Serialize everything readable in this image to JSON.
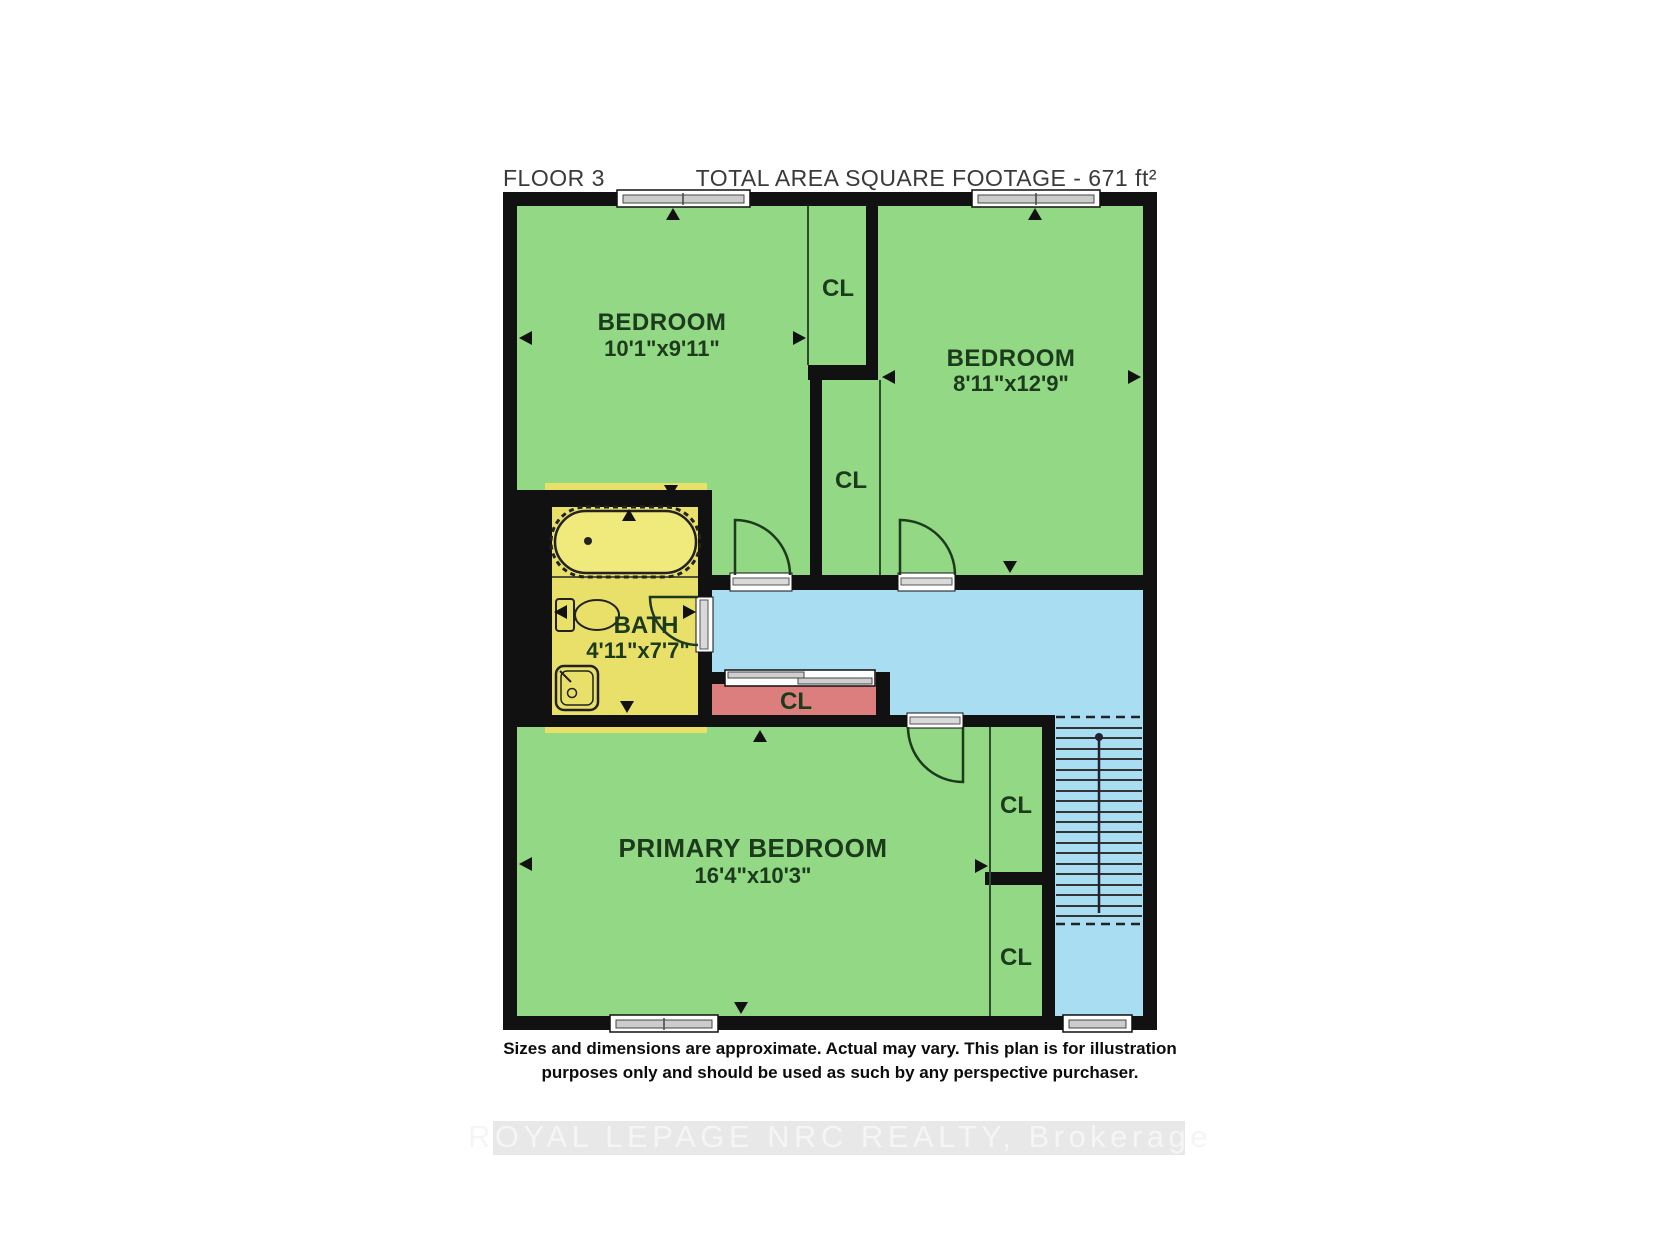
{
  "header": {
    "floor_label": "FLOOR 3",
    "area_label": "TOTAL AREA SQUARE FOOTAGE - 671 ft²"
  },
  "rooms": {
    "bedroom1": {
      "name": "BEDROOM",
      "dimensions": "10'1\"x9'11\""
    },
    "bedroom2": {
      "name": "BEDROOM",
      "dimensions": "8'11\"x12'9\""
    },
    "bath": {
      "name": "BATH",
      "dimensions": "4'11\"x7'7\""
    },
    "primary_bedroom": {
      "name": "PRIMARY BEDROOM",
      "dimensions": "16'4\"x10'3\""
    }
  },
  "labels": {
    "closet": "CL"
  },
  "disclaimer": {
    "line1": "Sizes and dimensions are approximate. Actual may vary. This plan is for illustration",
    "line2": "purposes only and should be used as such by any perspective purchaser."
  },
  "watermark": "ROYAL LEPAGE NRC REALTY, Brokerage",
  "colors": {
    "room_green": "#93d885",
    "bath_yellow": "#e9e06a",
    "hall_blue": "#a8ddf2",
    "closet_red": "#dd7e7e",
    "wall_black": "#111111"
  }
}
